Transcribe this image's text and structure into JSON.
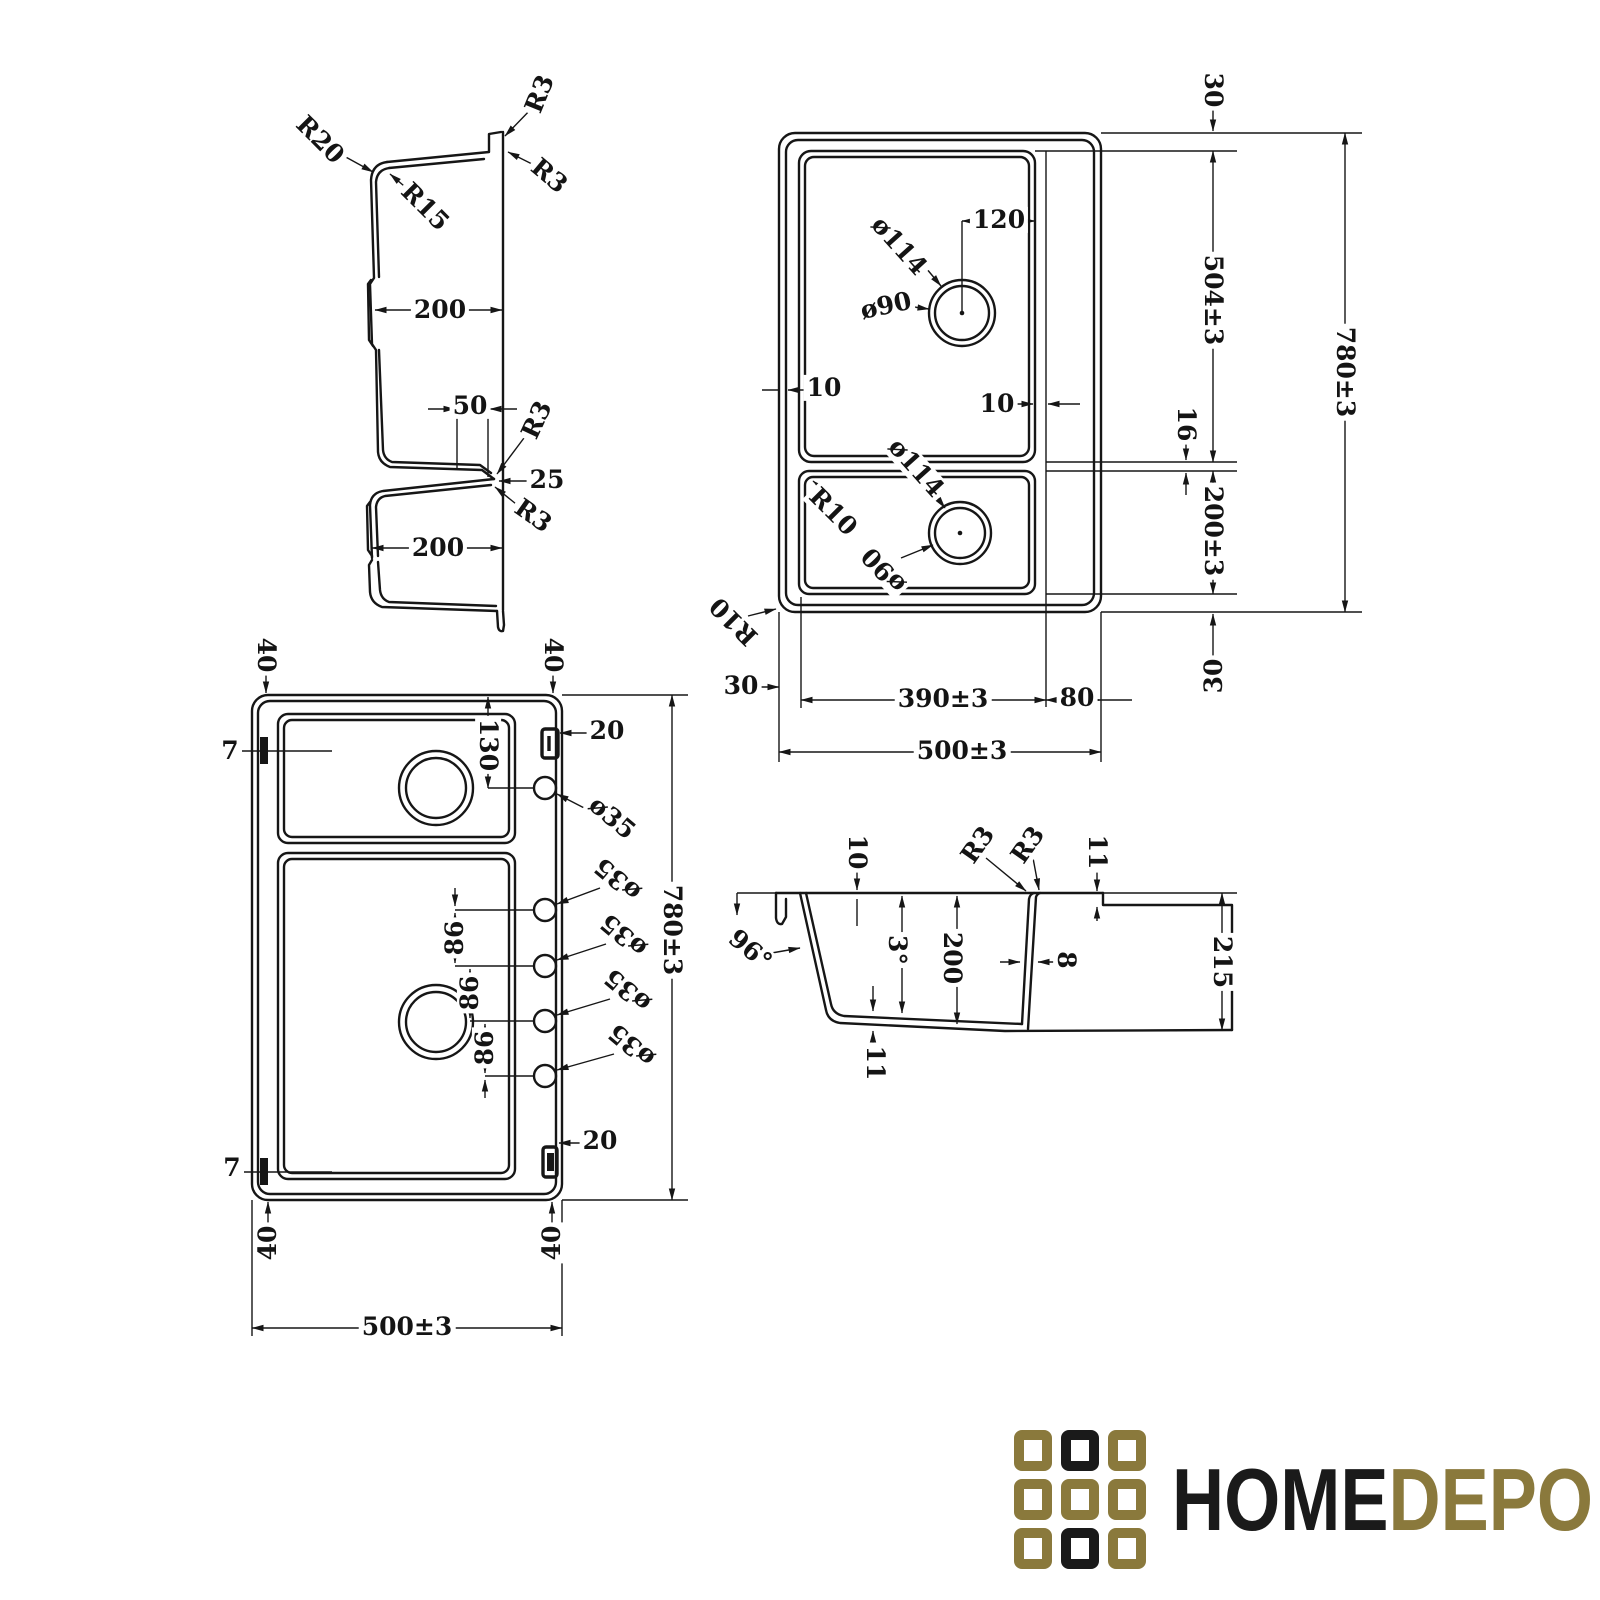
{
  "page": {
    "background": "#ffffff",
    "line_color": "#161616"
  },
  "logo": {
    "word_black": "HOME",
    "word_gold": "DEPO",
    "colors": {
      "gold": "#8a793c",
      "black": "#1a1a1a"
    },
    "grid_pattern": [
      [
        "gold",
        "black",
        "gold"
      ],
      [
        "gold",
        "gold",
        "gold"
      ],
      [
        "gold",
        "black",
        "gold"
      ]
    ]
  },
  "views": {
    "longitudinal_section": {
      "title": "double-bowl-length-section",
      "labels": [
        {
          "t": "R20",
          "x": 320,
          "y": 140,
          "r": 45
        },
        {
          "t": "R15",
          "x": 425,
          "y": 207,
          "r": 45
        },
        {
          "t": "R3",
          "x": 540,
          "y": 94,
          "r": -68
        },
        {
          "t": "R3",
          "x": 549,
          "y": 176,
          "r": 40
        },
        {
          "t": "200",
          "x": 440,
          "y": 310,
          "r": 0
        },
        {
          "t": "50",
          "x": 470,
          "y": 406,
          "r": 0
        },
        {
          "t": "R3",
          "x": 537,
          "y": 420,
          "r": -65
        },
        {
          "t": "25",
          "x": 547,
          "y": 480,
          "r": 0
        },
        {
          "t": "R3",
          "x": 533,
          "y": 516,
          "r": 35
        },
        {
          "t": "200",
          "x": 438,
          "y": 548,
          "r": 0
        }
      ]
    },
    "plan_view": {
      "title": "top-plan-view",
      "labels": [
        {
          "t": "30",
          "x": 1213,
          "y": 90,
          "r": 90
        },
        {
          "t": "120",
          "x": 999,
          "y": 220,
          "r": 0
        },
        {
          "t": "ø114",
          "x": 899,
          "y": 246,
          "r": 48
        },
        {
          "t": "ø90",
          "x": 886,
          "y": 306,
          "r": -12
        },
        {
          "t": "10",
          "x": 824,
          "y": 388,
          "r": 0
        },
        {
          "t": "10",
          "x": 997,
          "y": 404,
          "r": 0
        },
        {
          "t": "504±3",
          "x": 1213,
          "y": 300,
          "r": 90
        },
        {
          "t": "780±3",
          "x": 1345,
          "y": 372,
          "r": 90
        },
        {
          "t": "16",
          "x": 1186,
          "y": 424,
          "r": 90
        },
        {
          "t": "ø114",
          "x": 916,
          "y": 468,
          "r": 48
        },
        {
          "t": "R10",
          "x": 833,
          "y": 512,
          "r": 45
        },
        {
          "t": "200±3",
          "x": 1213,
          "y": 531,
          "r": 90
        },
        {
          "t": "ø90",
          "x": 884,
          "y": 570,
          "r": 227
        },
        {
          "t": "R10",
          "x": 734,
          "y": 621,
          "r": 225
        },
        {
          "t": "30",
          "x": 741,
          "y": 686,
          "r": 0
        },
        {
          "t": "390±3",
          "x": 943,
          "y": 699,
          "r": 0
        },
        {
          "t": "80",
          "x": 1077,
          "y": 698,
          "r": 0
        },
        {
          "t": "30",
          "x": 1214,
          "y": 676,
          "r": -90
        },
        {
          "t": "500±3",
          "x": 962,
          "y": 751,
          "r": 0
        }
      ]
    },
    "plan_view_holes": {
      "title": "bottom-plan-view-with-tap-holes",
      "labels": [
        {
          "t": "40",
          "x": 266,
          "y": 655,
          "r": 90
        },
        {
          "t": "40",
          "x": 553,
          "y": 655,
          "r": 90
        },
        {
          "t": "7",
          "x": 230,
          "y": 751,
          "r": 0
        },
        {
          "t": "20",
          "x": 607,
          "y": 731,
          "r": 0
        },
        {
          "t": "130",
          "x": 488,
          "y": 745,
          "r": 90
        },
        {
          "t": "ø35",
          "x": 612,
          "y": 818,
          "r": 40
        },
        {
          "t": "ø35",
          "x": 618,
          "y": 879,
          "r": 220
        },
        {
          "t": "ø35",
          "x": 624,
          "y": 935,
          "r": 220
        },
        {
          "t": "ø35",
          "x": 628,
          "y": 990,
          "r": 220
        },
        {
          "t": "ø35",
          "x": 632,
          "y": 1045,
          "r": 220
        },
        {
          "t": "86",
          "x": 455,
          "y": 938,
          "r": -90
        },
        {
          "t": "86",
          "x": 470,
          "y": 993,
          "r": -90
        },
        {
          "t": "86",
          "x": 485,
          "y": 1048,
          "r": -90
        },
        {
          "t": "780±3",
          "x": 672,
          "y": 930,
          "r": 90
        },
        {
          "t": "20",
          "x": 600,
          "y": 1141,
          "r": 0
        },
        {
          "t": "7",
          "x": 232,
          "y": 1168,
          "r": 0
        },
        {
          "t": "40",
          "x": 268,
          "y": 1243,
          "r": -90
        },
        {
          "t": "40",
          "x": 552,
          "y": 1243,
          "r": -90
        },
        {
          "t": "500±3",
          "x": 407,
          "y": 1327,
          "r": 0
        }
      ]
    },
    "cross_section": {
      "title": "bowl-cross-section",
      "labels": [
        {
          "t": "10",
          "x": 857,
          "y": 852,
          "r": 90
        },
        {
          "t": "R3",
          "x": 978,
          "y": 845,
          "r": -55
        },
        {
          "t": "R3",
          "x": 1028,
          "y": 845,
          "r": -55
        },
        {
          "t": "11",
          "x": 1097,
          "y": 852,
          "r": 90
        },
        {
          "t": "96°",
          "x": 750,
          "y": 950,
          "r": 40
        },
        {
          "t": "3°",
          "x": 897,
          "y": 950,
          "r": 90
        },
        {
          "t": "200",
          "x": 952,
          "y": 958,
          "r": 90
        },
        {
          "t": "8",
          "x": 1066,
          "y": 960,
          "r": 90
        },
        {
          "t": "215",
          "x": 1222,
          "y": 962,
          "r": 90
        },
        {
          "t": "11",
          "x": 875,
          "y": 1063,
          "r": 90
        }
      ]
    }
  }
}
